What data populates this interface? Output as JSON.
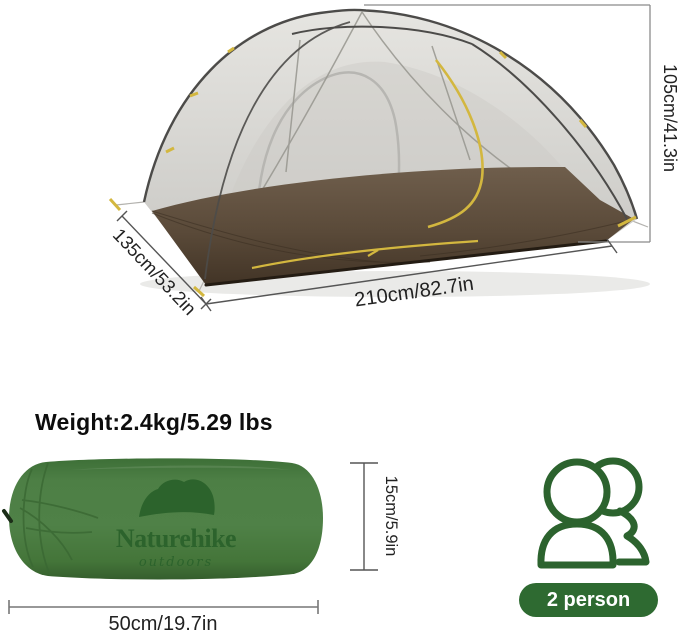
{
  "product": {
    "weight_label": "Weight:2.4kg/5.29 lbs",
    "capacity_badge": "2 person"
  },
  "tent_dimensions": {
    "height": "105cm/41.3in",
    "width": "135cm/53.2in",
    "length": "210cm/82.7in"
  },
  "bag": {
    "brand": "Naturehike",
    "tagline": "outdoors",
    "height": "15cm/5.9in",
    "length": "50cm/19.7in"
  },
  "icons": {
    "people_icon": "two-person-outline"
  },
  "colors": {
    "bag_green": "#4a7c42",
    "logo_green": "#2c632c",
    "badge_green": "#2e6a31",
    "icon_green": "#2c632e",
    "accent_yellow": "#d3b73f",
    "floor_brown": "#5d4d3d",
    "mesh_gray": "#d5d4d0",
    "dimension_line_gray": "#8b8b8b"
  }
}
